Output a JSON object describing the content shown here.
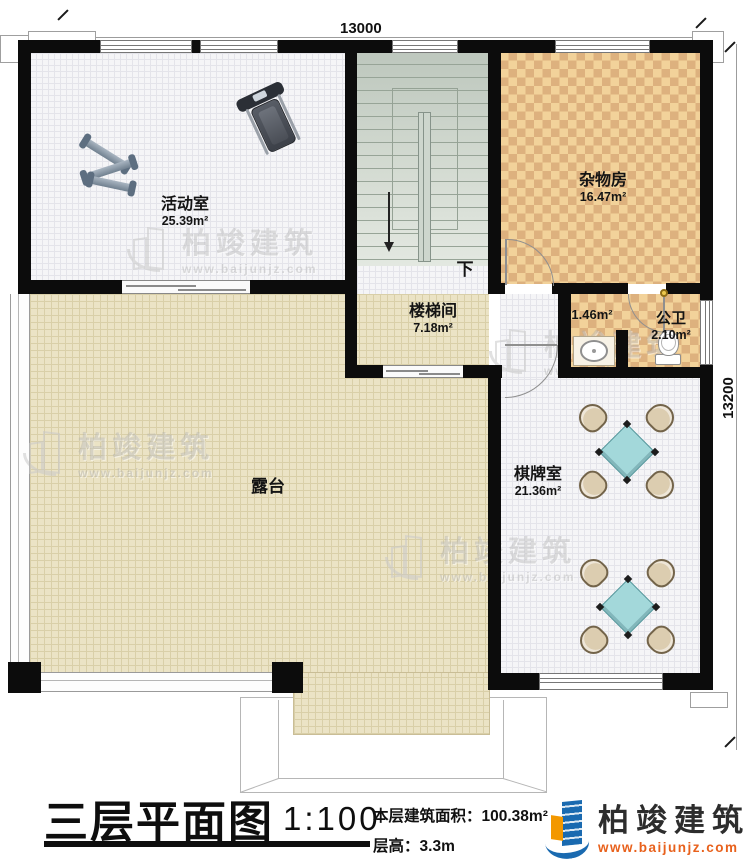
{
  "dimensions": {
    "top": "13000",
    "right": "13200"
  },
  "rooms": {
    "activity": {
      "name": "活动室",
      "area": "25.39m²"
    },
    "storage": {
      "name": "杂物房",
      "area": "16.47m²"
    },
    "stairwell": {
      "name": "楼梯间",
      "area": "7.18m²"
    },
    "corridor": {
      "area": "1.46m²"
    },
    "bathroom": {
      "name": "公卫",
      "area": "2.10m²"
    },
    "chess": {
      "name": "棋牌室",
      "area": "21.36m²"
    },
    "terrace": {
      "name": "露台"
    }
  },
  "stairs": {
    "direction_label": "下"
  },
  "watermark": {
    "brand": "柏竣建筑",
    "url": "www.baijunjz.com"
  },
  "title_block": {
    "title": "三层平面图",
    "scale": "1:100",
    "floor_area_label": "本层建筑面积：",
    "floor_area_value": "100.38m²",
    "floor_height_label": "层高：",
    "floor_height_value": "3.3m"
  },
  "logo": {
    "brand": "柏竣建筑",
    "url": "www.baijunjz.com"
  },
  "colors": {
    "wall": "#0c0c0c",
    "terrace_floor": "#ebe3c5",
    "checker_light": "#f2d29a",
    "checker_dark": "#ddb17e",
    "table_teal": "#a3d8da",
    "logo_blue": "#1a6ab0",
    "logo_orange": "#f39800",
    "logo_url_color": "#e8611c"
  }
}
